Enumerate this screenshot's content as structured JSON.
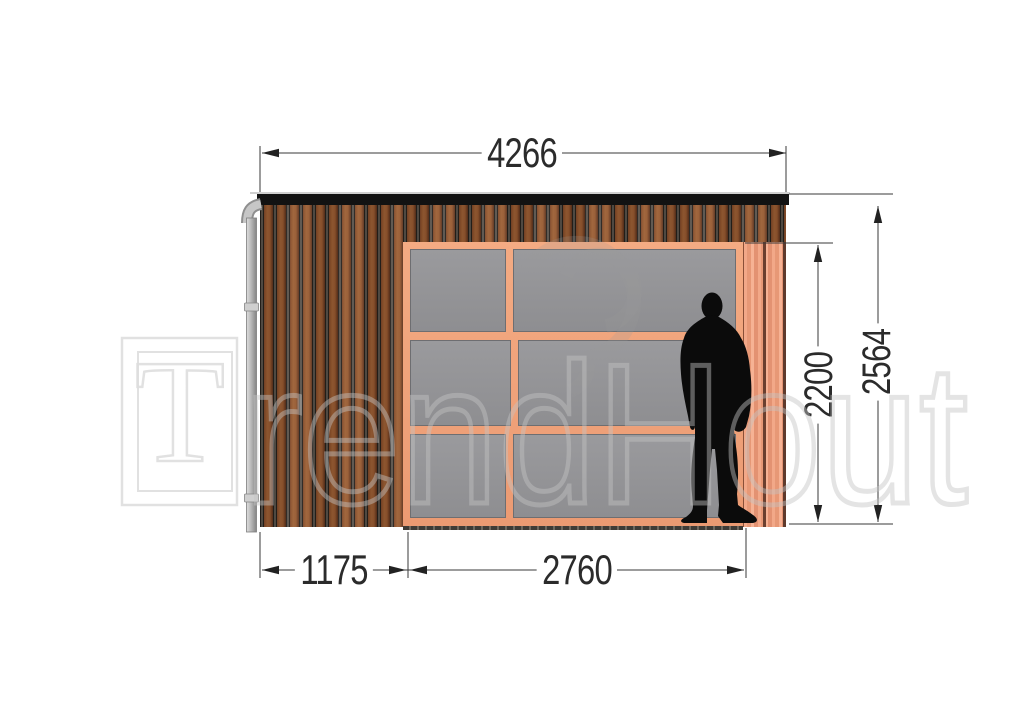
{
  "drawing": {
    "type": "facade elevation",
    "dimensions_mm": {
      "overall_width": "4266",
      "overall_height": "2564",
      "opening_height": "2200",
      "cladding_section_width": "1175",
      "glazed_section_width": "2760"
    },
    "watermark": {
      "logo_letter": "T",
      "logo_text_rest": "rendHout"
    },
    "colors": {
      "roof": "#121212",
      "cladding_brown": "#8f5630",
      "frame_salmon": "#eea07c",
      "glass_gray": "#939396",
      "silhouette": "#0b0b0b",
      "downpipe_gray": "#b4b4b4",
      "dimension_ink": "#2b2b2b"
    }
  }
}
